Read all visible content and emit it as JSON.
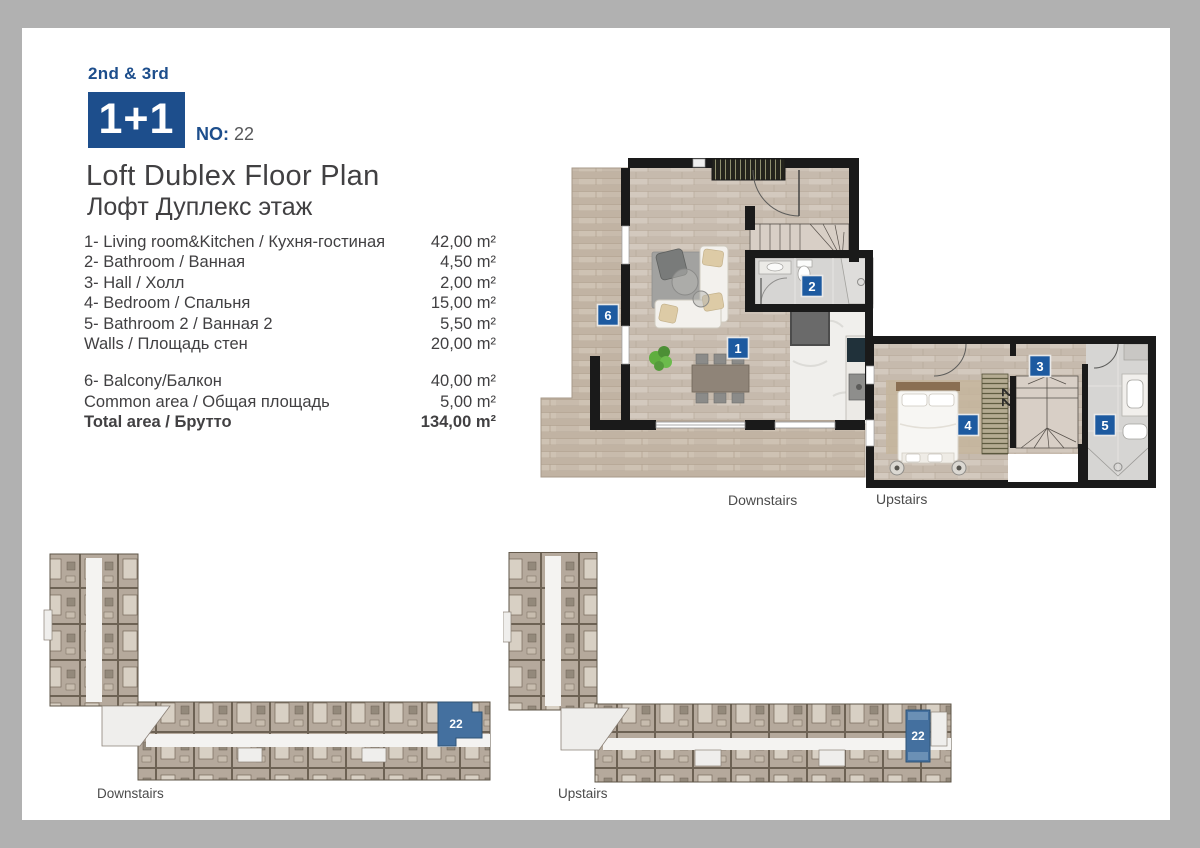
{
  "header": {
    "floors": "2nd & 3rd",
    "unit_type": "1+1",
    "no_label": "NO:",
    "unit_no": "22",
    "title_en": "Loft Dublex Floor Plan",
    "title_ru": "Лофт Дуплекс этаж"
  },
  "rooms": [
    {
      "label": "1- Living room&Kitchen / Кухня-гостиная",
      "area": "42,00 m²"
    },
    {
      "label": "2- Bathroom / Ванная",
      "area": "4,50 m²"
    },
    {
      "label": "3- Hall / Холл",
      "area": "2,00 m²"
    },
    {
      "label": "4- Bedroom  / Спальня",
      "area": "15,00 m²"
    },
    {
      "label": "5- Bathroom 2 / Ванная 2",
      "area": "5,50 m²"
    },
    {
      "label": "Walls / Площадь стен",
      "area": "20,00 m²"
    }
  ],
  "extras": [
    {
      "label": "6- Balcony/Балкон",
      "area": "40,00 m²"
    },
    {
      "label": "Common area / Общая площадь",
      "area": "5,00 m²"
    }
  ],
  "total": {
    "label": "Total area / Брутто",
    "area": "134,00 m²"
  },
  "plan": {
    "downstairs_label": "Downstairs",
    "upstairs_label": "Upstairs",
    "badge_living": "1",
    "badge_bathroom": "2",
    "badge_hall": "3",
    "badge_bedroom": "4",
    "badge_bathroom2": "5",
    "badge_balcony": "6",
    "closet_no": "22"
  },
  "overview": {
    "downstairs_label": "Downstairs",
    "upstairs_label": "Upstairs",
    "unit_no": "22"
  },
  "colors": {
    "brand_blue": "#1d4e8c",
    "badge_blue": "#1d5aa0",
    "highlight_blue": "#44709f",
    "text_dark": "#414042",
    "wall_black": "#1a1a1a"
  }
}
